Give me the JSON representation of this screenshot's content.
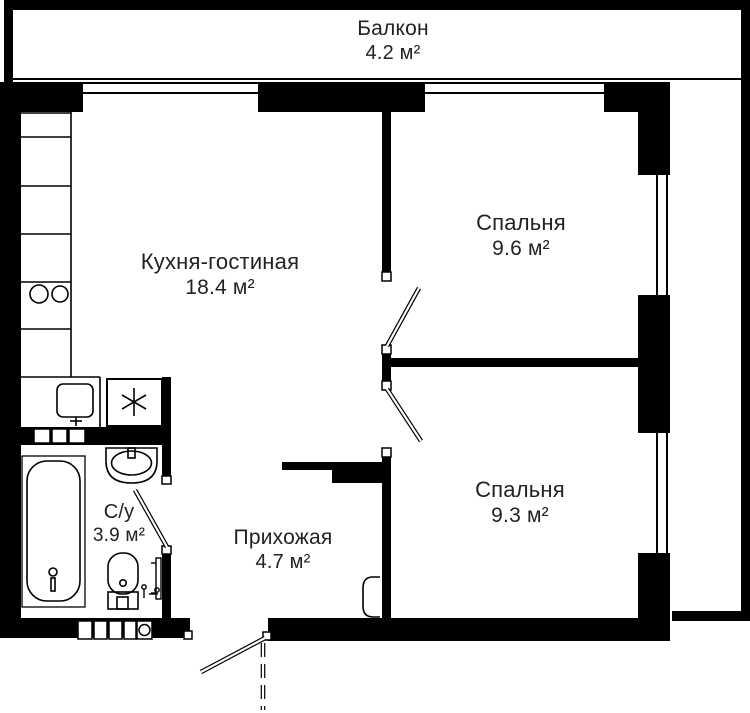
{
  "plan": {
    "type": "apartment-floor-plan",
    "colors": {
      "wall": "#000000",
      "background": "#ffffff",
      "text": "#222222"
    },
    "rooms": [
      {
        "id": "balcony",
        "name": "Балкон",
        "area": "4.2 м²"
      },
      {
        "id": "kitchen-living",
        "name": "Кухня-гостиная",
        "area": "18.4 м²"
      },
      {
        "id": "bedroom-top",
        "name": "Спальня",
        "area": "9.6 м²"
      },
      {
        "id": "bedroom-bottom",
        "name": "Спальня",
        "area": "9.3 м²"
      },
      {
        "id": "bathroom",
        "name": "С/у",
        "area": "3.9 м²"
      },
      {
        "id": "hallway",
        "name": "Прихожая",
        "area": "4.7 м²"
      }
    ],
    "fixtures": [
      "kitchen-counter",
      "hob-2-burners",
      "kitchen-sink",
      "refrigerator",
      "bathtub",
      "washbasin",
      "toilet",
      "towel-rail",
      "electric-panel",
      "ventilation-shafts",
      "entry-door",
      "interior-doors",
      "windows"
    ]
  }
}
